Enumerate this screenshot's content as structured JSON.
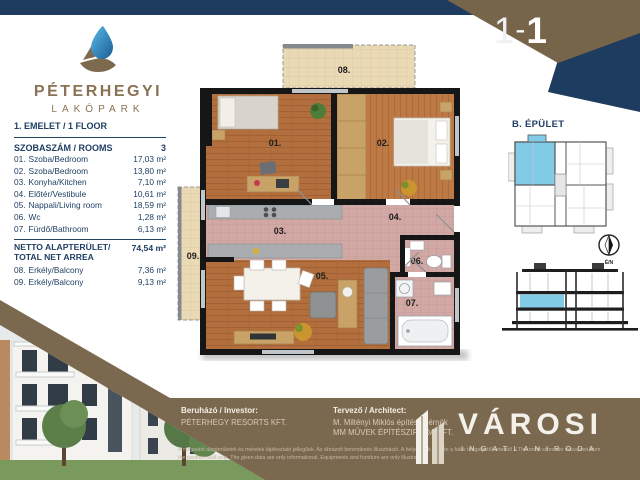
{
  "banner": {
    "unit_label": "B-1-1",
    "parts": [
      "B",
      "-",
      "1",
      "-",
      "1"
    ]
  },
  "logo": {
    "title": "PÉTERHEGYI",
    "subtitle": "LAKÓPARK"
  },
  "sidebar": {
    "floor_label": "1. EMELET / 1 FLOOR",
    "rooms_header": {
      "label": "SZOBASZÁM / ROOMS",
      "value": "3"
    },
    "rooms": [
      {
        "num": "01.",
        "name": "Szoba/Bedroom",
        "area": "17,03 m²"
      },
      {
        "num": "02.",
        "name": "Szoba/Bedroom",
        "area": "13,80 m²"
      },
      {
        "num": "03.",
        "name": "Konyha/Kitchen",
        "area": "7,10 m²"
      },
      {
        "num": "04.",
        "name": "Előtér/Vestibule",
        "area": "10,61 m²"
      },
      {
        "num": "05.",
        "name": "Nappali/Living room",
        "area": "18,59 m²"
      },
      {
        "num": "06.",
        "name": "Wc",
        "area": "1,28 m²"
      },
      {
        "num": "07.",
        "name": "Fürdő/Bathroom",
        "area": "6,13 m²"
      }
    ],
    "net": {
      "label1": "NETTO ALAPTERÜLET/",
      "label2": "TOTAL NET ARREA",
      "value": "74,54 m²"
    },
    "balconies": [
      {
        "num": "08.",
        "name": "Erkély/Balcony",
        "area": "7,36 m²"
      },
      {
        "num": "09.",
        "name": "Erkély/Balcony",
        "area": "9,13 m²"
      }
    ]
  },
  "plan": {
    "rooms": {
      "r01": "01.",
      "r02": "02.",
      "r03": "03.",
      "r04": "04.",
      "r05": "05.",
      "r06": "06.",
      "r07": "07.",
      "r08": "08.",
      "r09": "09."
    }
  },
  "building": {
    "title": "B. ÉPÜLET",
    "compass": "É/N"
  },
  "footer": {
    "investor": {
      "label": "Beruházó / Investor:",
      "name": "PÉTERHEGY RESORTS KFT."
    },
    "architect": {
      "label": "Tervező / Architect:",
      "line1": "M. Miltényi Miklós építészmérnök",
      "line2": "MM MŰVEK ÉPÍTÉSZIRODA KFT."
    },
    "disclaimer": {
      "l1": "A megadott alapterületek és méretek tájékoztató jellegűek. Az ábrázolt berendezés illusztráció. A helyiségek mérete a falak tengelyétől értendő. / The room sizes are measured from",
      "l2": "the partition wall-axis. The given data are only informational. Equipments and furniture are only illustration."
    },
    "agency": {
      "name": "VÁROSI",
      "subtitle": "INGATLANIRODA"
    }
  },
  "colors": {
    "navy": "#1e3c5f",
    "brown": "#7b694f",
    "logo_brown": "#8a7254",
    "highlight_blue": "#82cbe6",
    "wood": "#b26f3d",
    "wood_light": "#bd7a45",
    "tile": "#ead9b5",
    "pink_tile": "#d2a8a4",
    "counter_grey": "#a9adb0"
  }
}
